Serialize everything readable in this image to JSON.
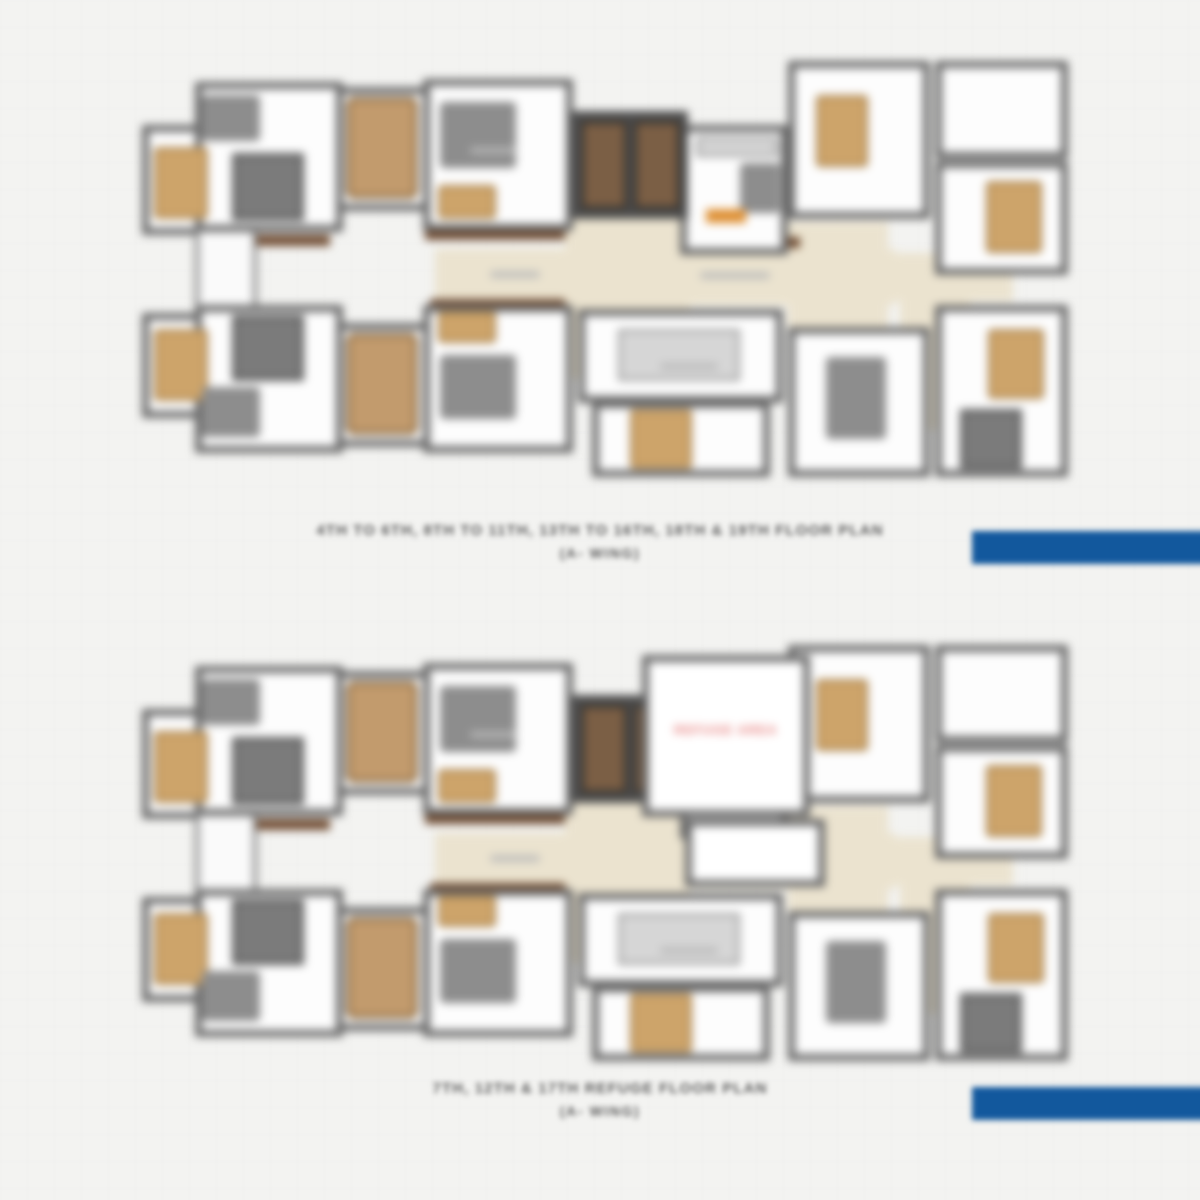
{
  "page": {
    "background": "#f3f3f1",
    "accent_color": "#12589d"
  },
  "palette": {
    "wall_gray": "#686868",
    "floor_cream": "#ebe3cf",
    "lift_brown": "#7b5f45",
    "bed_tan": "#cda46a",
    "refuge_red": "#e4716f"
  },
  "plans": [
    {
      "caption_line1": "4TH TO 6TH, 8TH TO 11TH, 13TH TO 16TH, 18TH & 19TH FLOOR PLAN",
      "caption_line2": "(A- WING)"
    },
    {
      "caption_line1": "7TH, 12TH & 17TH REFUGE FLOOR PLAN",
      "caption_line2": "(A- WING)",
      "refuge_label": "REFUGE AREA"
    }
  ]
}
